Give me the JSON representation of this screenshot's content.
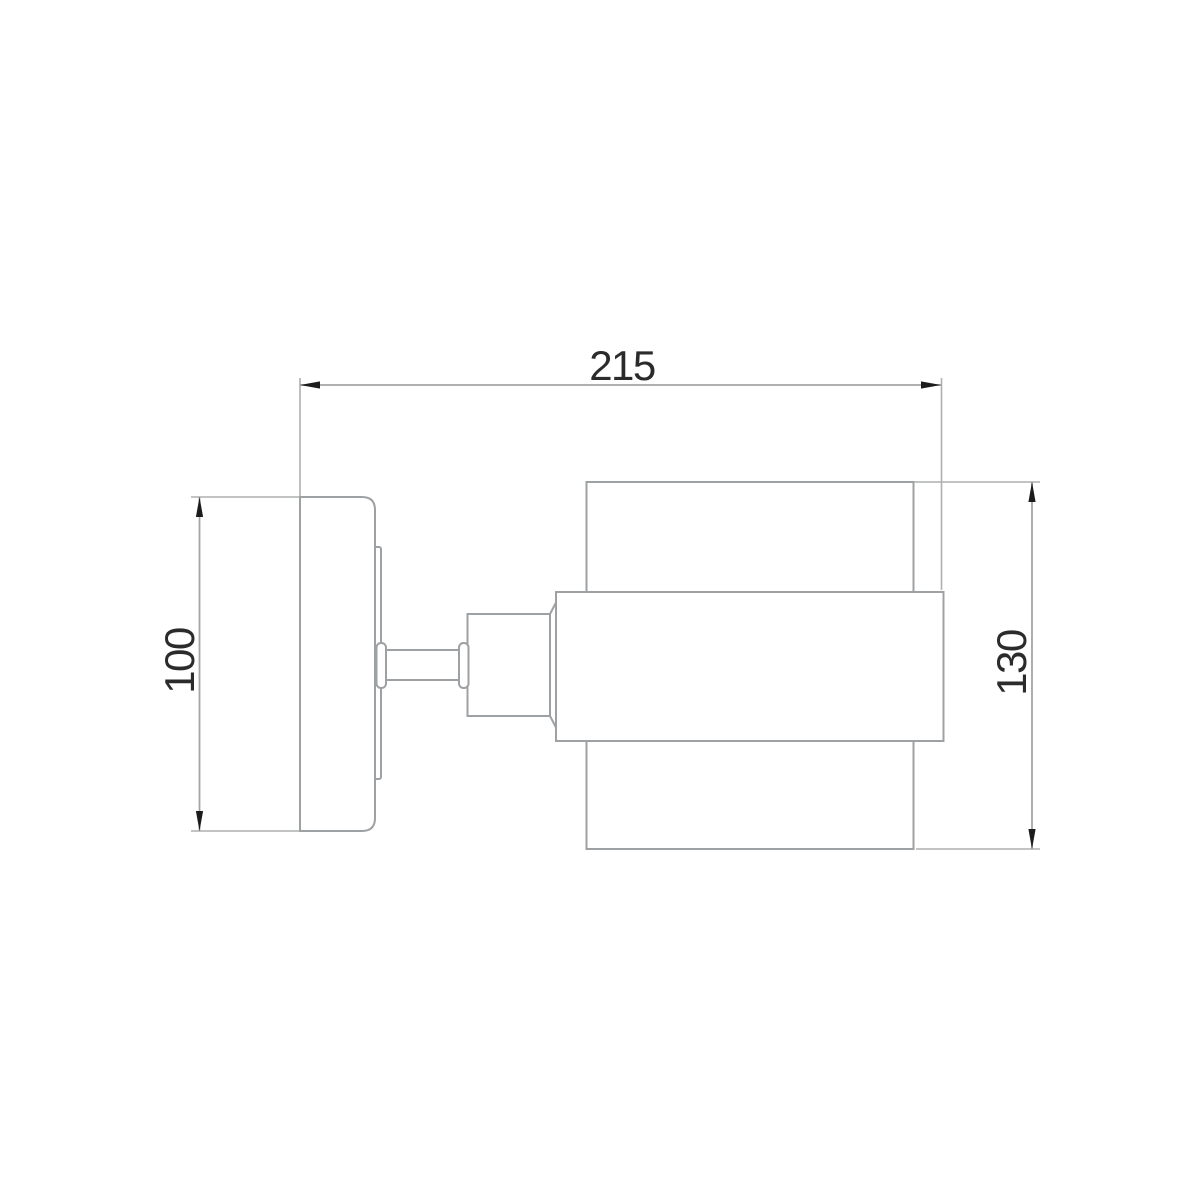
{
  "drawing": {
    "kind": "technical-dimension-drawing",
    "subject": "wall-sconce-side-view",
    "background_color": "#ffffff",
    "outline_color": "#9ea1a3",
    "dimension_line_color": "#a3a5a6",
    "arrow_color": "#1c1c1c",
    "text_color": "#2b2b2b",
    "dimensions": {
      "overall_depth": {
        "label": "215",
        "orientation": "horizontal",
        "position": "top"
      },
      "backplate_height": {
        "label": "100",
        "orientation": "vertical",
        "position": "left"
      },
      "shade_height": {
        "label": "130",
        "orientation": "vertical",
        "position": "right"
      }
    },
    "parts": [
      "wall-plate",
      "mounting-ring",
      "pivot-hub",
      "arm-tube",
      "arm-collar",
      "socket-housing",
      "shade-band",
      "shade-cylinder"
    ]
  }
}
